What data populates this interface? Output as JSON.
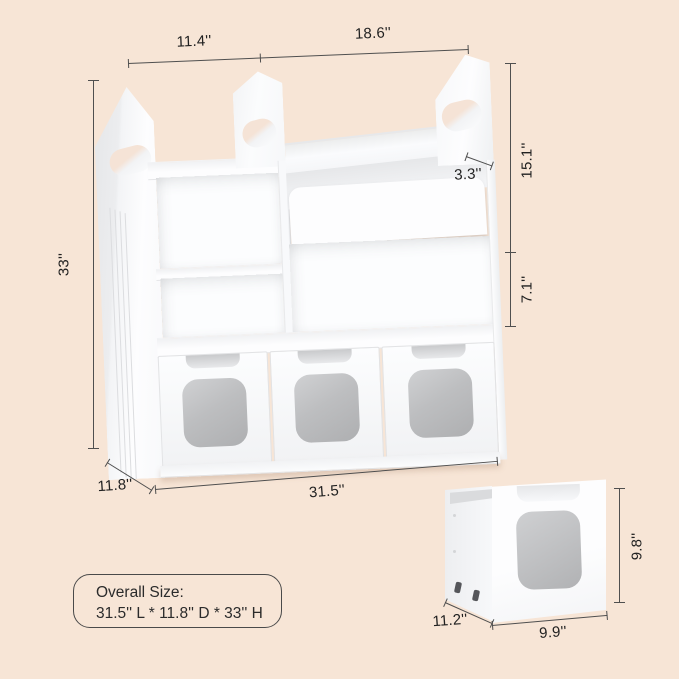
{
  "colors": {
    "background": "#f7e5d6",
    "furniture_white": "#fcfdfe",
    "panel_shade": "#e8e9eb",
    "drawer_window_gray": "#bcbdbf",
    "dimension_line": "#4f4f4f",
    "dimension_text": "#212121"
  },
  "annotations": {
    "main_unit": {
      "top_left_width": "11.4''",
      "top_right_width": "18.6''",
      "height": "33''",
      "tray_depth": "3.3''",
      "upper_height": "15.1''",
      "shelf_height": "7.1''",
      "depth": "11.8''",
      "width": "31.5''"
    },
    "rolling_drawer": {
      "height": "9.8''",
      "depth": "11.2''",
      "width": "9.9''"
    }
  },
  "overall_size_box": {
    "title": "Overall Size:",
    "value": "31.5'' L * 11.8'' D * 33'' H"
  }
}
